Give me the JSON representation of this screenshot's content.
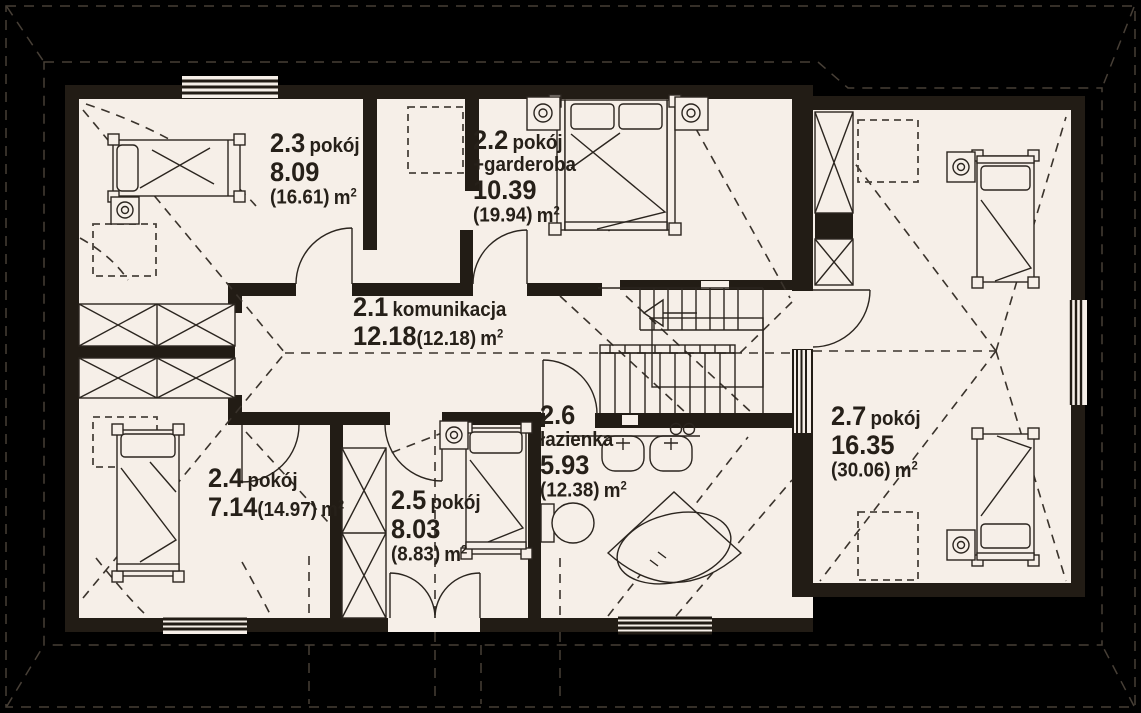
{
  "plan": {
    "type": "floor-plan",
    "language": "pl",
    "unit": "m",
    "unit_sup": "2",
    "rooms": [
      {
        "id": "2.3",
        "name": "pokój",
        "area": "8.09",
        "total": "(16.61)"
      },
      {
        "id": "2.2",
        "name": "pokój",
        "name2": "+garderoba",
        "area": "10.39",
        "total": "(19.94)"
      },
      {
        "id": "2.1",
        "name": "komunikacja",
        "area": "12.18",
        "total": "(12.18)"
      },
      {
        "id": "2.4",
        "name": "pokój",
        "area": "7.14",
        "total": "(14.97)"
      },
      {
        "id": "2.5",
        "name": "pokój",
        "area": "8.03",
        "total": "(8.83)"
      },
      {
        "id": "2.6",
        "name": "łazienka",
        "area": "5.93",
        "total": "(12.38)"
      },
      {
        "id": "2.7",
        "name": "pokój",
        "area": "16.35",
        "total": "(30.06)"
      }
    ],
    "colors": {
      "background": "#000000",
      "floor": "#f6efe8",
      "wall": "#221c15",
      "line": "#2b251f"
    }
  }
}
